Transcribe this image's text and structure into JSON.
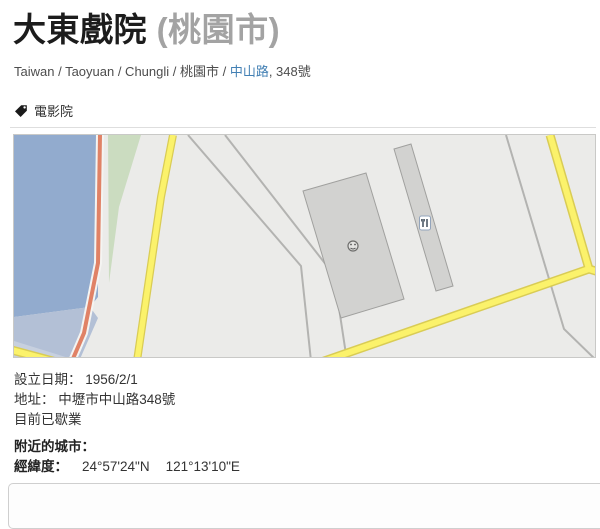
{
  "page": {
    "title": "大東戲院",
    "title_suffix": "(桃園市)",
    "tag_label": "電影院"
  },
  "breadcrumb": {
    "before_link": "Taiwan / Taoyuan / Chungli / 桃園市 / ",
    "link": "中山路",
    "after_link": ", 348號"
  },
  "details": {
    "established_label": "設立日期：",
    "established_value": "1956/2/1",
    "address_label": "地址：",
    "address_value": "中壢市中山路348號",
    "status": "目前已歇業",
    "nearby_label": "附近的城市：",
    "coords_label": "經緯度：",
    "coords_lat": "24°57'24\"N",
    "coords_lng": "121°13'10\"E"
  },
  "map": {
    "markers": [
      "theater-face-marker",
      "restaurant-marker"
    ],
    "colors": {
      "map-bg": "#ebebe9",
      "water": "#92abce",
      "water-light": "#b3c0d6",
      "water-lighter": "#c7d0df",
      "green": "#cbdcc0",
      "road-yellow": "#fbf26b",
      "road-yellow-border": "#d9cc55",
      "road-red": "#e08266",
      "road-gray": "#b3b3b1",
      "building": "#d2d2d0",
      "building-border": "#a0a09e"
    }
  }
}
